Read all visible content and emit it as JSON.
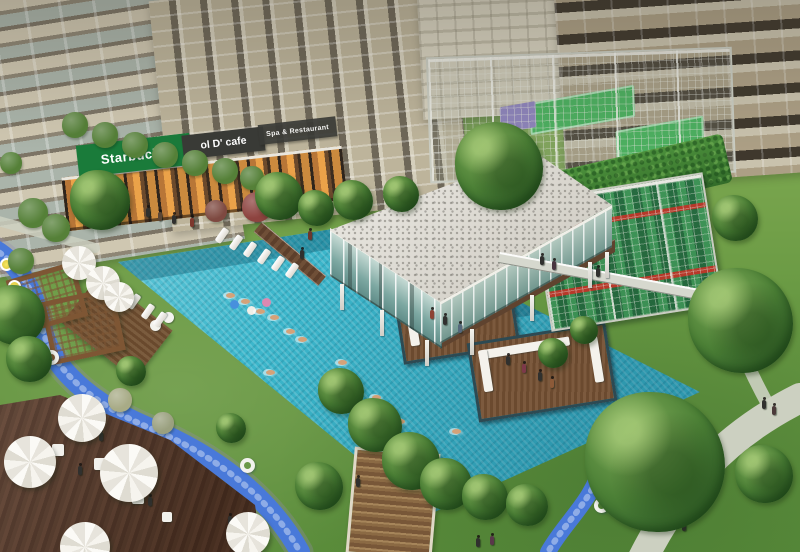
{
  "scene": {
    "description": "Aerial rendering of a condominium amenity court: lap pool with floating lounge decks, glass clubhouse with pebble roof, caged rooftop sports courts, climbing-wall pavilion, lazy-river streams, umbrella dining decks and high-rise towers",
    "signs": {
      "starbucks": "Starbucks",
      "cafe": "ol D' cafe",
      "spa": "Spa & Restaurant"
    },
    "colors": {
      "pool": "#41b6ca",
      "deep": "#1f7f9b",
      "grass": "#6f9c4a",
      "wood": "#5e4030",
      "stream": "#4b79d4",
      "roof": "#e3e0da",
      "facade": "#b5a88e",
      "glass": "#9fc3bd",
      "green": "#1d7a3c",
      "signdark": "#393a36",
      "court": "#4fae62",
      "red": "#b23a2c",
      "path": "#ccd0c2"
    },
    "sprites": [
      {
        "t": "col",
        "x": 340,
        "y": 284
      },
      {
        "t": "col",
        "x": 380,
        "y": 310
      },
      {
        "t": "col",
        "x": 425,
        "y": 340
      },
      {
        "t": "col",
        "x": 470,
        "y": 329
      },
      {
        "t": "col",
        "x": 530,
        "y": 295
      },
      {
        "t": "col",
        "x": 588,
        "y": 262
      },
      {
        "t": "col",
        "x": 605,
        "y": 252
      },
      {
        "t": "tbl",
        "x": 52,
        "y": 444,
        "s": 12
      },
      {
        "t": "tbl",
        "x": 94,
        "y": 458,
        "s": 12
      },
      {
        "t": "tbl",
        "x": 132,
        "y": 492,
        "s": 12
      },
      {
        "t": "tbl",
        "x": 162,
        "y": 512,
        "s": 10
      },
      {
        "t": "puff",
        "x": 150,
        "y": 320,
        "s": 11
      },
      {
        "t": "puff",
        "x": 163,
        "y": 312,
        "s": 11
      },
      {
        "t": "lounger",
        "x": 214,
        "y": 232
      },
      {
        "t": "lounger",
        "x": 228,
        "y": 239
      },
      {
        "t": "lounger",
        "x": 242,
        "y": 246
      },
      {
        "t": "lounger",
        "x": 256,
        "y": 253
      },
      {
        "t": "lounger",
        "x": 270,
        "y": 260
      },
      {
        "t": "lounger",
        "x": 284,
        "y": 267
      },
      {
        "t": "lounger",
        "x": 126,
        "y": 298
      },
      {
        "t": "lounger",
        "x": 140,
        "y": 308
      },
      {
        "t": "lounger",
        "x": 152,
        "y": 316
      },
      {
        "t": "ring",
        "x": 594,
        "y": 498
      },
      {
        "t": "ring",
        "x": 240,
        "y": 458
      },
      {
        "t": "ring",
        "x": 44,
        "y": 350
      },
      {
        "t": "fyel",
        "x": 0,
        "y": 258
      },
      {
        "t": "fyel",
        "x": 8,
        "y": 280
      },
      {
        "t": "fball",
        "x": 230,
        "y": 300,
        "c": "#4a90d9"
      },
      {
        "t": "fball",
        "x": 262,
        "y": 298,
        "c": "#d98ab0"
      },
      {
        "t": "fball",
        "x": 247,
        "y": 306,
        "c": "#f0efe8"
      },
      {
        "t": "swim",
        "x": 226,
        "y": 293
      },
      {
        "t": "swim",
        "x": 241,
        "y": 299
      },
      {
        "t": "swim",
        "x": 256,
        "y": 309
      },
      {
        "t": "swim",
        "x": 270,
        "y": 315
      },
      {
        "t": "swim",
        "x": 286,
        "y": 329
      },
      {
        "t": "swim",
        "x": 298,
        "y": 337
      },
      {
        "t": "swim",
        "x": 338,
        "y": 360
      },
      {
        "t": "swim",
        "x": 266,
        "y": 370
      },
      {
        "t": "swim",
        "x": 372,
        "y": 395
      },
      {
        "t": "swim",
        "x": 396,
        "y": 419
      },
      {
        "t": "swim",
        "x": 452,
        "y": 429
      },
      {
        "t": "person",
        "x": 146,
        "y": 208,
        "c": "#30302e"
      },
      {
        "t": "person",
        "x": 158,
        "y": 212,
        "c": "#5a4636"
      },
      {
        "t": "person",
        "x": 172,
        "y": 215,
        "c": "#30302e"
      },
      {
        "t": "person",
        "x": 190,
        "y": 218,
        "c": "#7a382e"
      },
      {
        "t": "person",
        "x": 122,
        "y": 204,
        "c": "#30302e"
      },
      {
        "t": "person",
        "x": 46,
        "y": 222,
        "c": "#30302e"
      },
      {
        "t": "person",
        "x": 58,
        "y": 228,
        "c": "#46465a"
      },
      {
        "t": "person",
        "x": 300,
        "y": 250,
        "c": "#30302e"
      },
      {
        "t": "person",
        "x": 308,
        "y": 231,
        "c": "#6a382e"
      },
      {
        "t": "person",
        "x": 540,
        "y": 256,
        "c": "#30302e"
      },
      {
        "t": "person",
        "x": 552,
        "y": 261,
        "c": "#483440"
      },
      {
        "t": "person",
        "x": 596,
        "y": 268,
        "c": "#30302e"
      },
      {
        "t": "person",
        "x": 430,
        "y": 310,
        "c": "#8a4436"
      },
      {
        "t": "person",
        "x": 443,
        "y": 316,
        "c": "#30302e"
      },
      {
        "t": "person",
        "x": 458,
        "y": 324,
        "c": "#56687a"
      },
      {
        "t": "person",
        "x": 506,
        "y": 356,
        "c": "#30302e"
      },
      {
        "t": "person",
        "x": 522,
        "y": 364,
        "c": "#7a3a4a"
      },
      {
        "t": "person",
        "x": 538,
        "y": 372,
        "c": "#30302e"
      },
      {
        "t": "person",
        "x": 550,
        "y": 379,
        "c": "#8a5a3a"
      },
      {
        "t": "person",
        "x": 476,
        "y": 538,
        "c": "#30302e"
      },
      {
        "t": "person",
        "x": 490,
        "y": 536,
        "c": "#58384a"
      },
      {
        "t": "person",
        "x": 690,
        "y": 494,
        "c": "#30302e"
      },
      {
        "t": "person",
        "x": 700,
        "y": 498,
        "c": "#553a38"
      },
      {
        "t": "person",
        "x": 682,
        "y": 522,
        "c": "#30302e"
      },
      {
        "t": "person",
        "x": 730,
        "y": 290,
        "c": "#30302e"
      },
      {
        "t": "person",
        "x": 740,
        "y": 294,
        "c": "#4a3a4e"
      },
      {
        "t": "person",
        "x": 750,
        "y": 289,
        "c": "#30302e"
      },
      {
        "t": "person",
        "x": 758,
        "y": 295,
        "c": "#5a4838"
      },
      {
        "t": "person",
        "x": 90,
        "y": 428,
        "c": "#7a382e"
      },
      {
        "t": "person",
        "x": 99,
        "y": 432,
        "c": "#30302e"
      },
      {
        "t": "person",
        "x": 78,
        "y": 466,
        "c": "#30302e"
      },
      {
        "t": "person",
        "x": 116,
        "y": 488,
        "c": "#46465a"
      },
      {
        "t": "person",
        "x": 148,
        "y": 497,
        "c": "#30302e"
      },
      {
        "t": "person",
        "x": 228,
        "y": 516,
        "c": "#30302e"
      },
      {
        "t": "person",
        "x": 356,
        "y": 478,
        "c": "#30302e"
      },
      {
        "t": "person",
        "x": 762,
        "y": 400,
        "c": "#30302e"
      },
      {
        "t": "person",
        "x": 772,
        "y": 406,
        "c": "#4a3a3a"
      },
      {
        "t": "bush",
        "x": 62,
        "y": 112,
        "s": 26
      },
      {
        "t": "bush",
        "x": 92,
        "y": 122,
        "s": 26
      },
      {
        "t": "bush",
        "x": 122,
        "y": 132,
        "s": 26
      },
      {
        "t": "bush",
        "x": 152,
        "y": 142,
        "s": 26
      },
      {
        "t": "bush",
        "x": 182,
        "y": 150,
        "s": 26
      },
      {
        "t": "bush",
        "x": 212,
        "y": 158,
        "s": 26
      },
      {
        "t": "bush",
        "x": 240,
        "y": 166,
        "s": 24
      },
      {
        "t": "bush",
        "x": 18,
        "y": 198,
        "s": 30
      },
      {
        "t": "bush",
        "x": 42,
        "y": 214,
        "s": 28
      },
      {
        "t": "bush",
        "x": 8,
        "y": 248,
        "s": 26
      },
      {
        "t": "bush",
        "x": 0,
        "y": 152,
        "s": 22
      },
      {
        "t": "bush",
        "x": 242,
        "y": 192,
        "s": 30,
        "c": "#8a4440"
      },
      {
        "t": "bush",
        "x": 205,
        "y": 200,
        "s": 22,
        "c": "#7c4a42"
      },
      {
        "t": "bush",
        "x": 108,
        "y": 388,
        "s": 24,
        "c": "#a8ab88"
      },
      {
        "t": "bush",
        "x": 152,
        "y": 412,
        "s": 22,
        "c": "#9aa080"
      },
      {
        "t": "tree",
        "x": 585,
        "y": 392,
        "s": 140
      },
      {
        "t": "tree",
        "x": 688,
        "y": 268,
        "s": 105
      },
      {
        "t": "tree",
        "x": 318,
        "y": 368,
        "s": 46
      },
      {
        "t": "tree",
        "x": 348,
        "y": 398,
        "s": 54
      },
      {
        "t": "tree",
        "x": 382,
        "y": 432,
        "s": 58
      },
      {
        "t": "tree",
        "x": 420,
        "y": 458,
        "s": 52
      },
      {
        "t": "tree",
        "x": 462,
        "y": 474,
        "s": 46
      },
      {
        "t": "tree",
        "x": 506,
        "y": 484,
        "s": 42
      },
      {
        "t": "tree",
        "x": 295,
        "y": 462,
        "s": 48
      },
      {
        "t": "tree",
        "x": 70,
        "y": 170,
        "s": 60
      },
      {
        "t": "tree",
        "x": 255,
        "y": 172,
        "s": 48
      },
      {
        "t": "tree",
        "x": 298,
        "y": 190,
        "s": 36
      },
      {
        "t": "tree",
        "x": 333,
        "y": 180,
        "s": 40
      },
      {
        "t": "tree",
        "x": 383,
        "y": 176,
        "s": 36
      },
      {
        "t": "tree",
        "x": 455,
        "y": 122,
        "s": 88
      },
      {
        "t": "tree",
        "x": -15,
        "y": 285,
        "s": 60
      },
      {
        "t": "tree",
        "x": 6,
        "y": 336,
        "s": 46
      },
      {
        "t": "tree",
        "x": 735,
        "y": 445,
        "s": 58
      },
      {
        "t": "tree",
        "x": 538,
        "y": 338,
        "s": 30
      },
      {
        "t": "tree",
        "x": 570,
        "y": 316,
        "s": 28
      },
      {
        "t": "tree",
        "x": 216,
        "y": 413,
        "s": 30
      },
      {
        "t": "tree",
        "x": 116,
        "y": 356,
        "s": 30
      },
      {
        "t": "tree",
        "x": 712,
        "y": 195,
        "s": 46
      },
      {
        "t": "umb",
        "x": 4,
        "y": 436,
        "s": 52
      },
      {
        "t": "umb",
        "x": 58,
        "y": 394,
        "s": 48
      },
      {
        "t": "umb",
        "x": 100,
        "y": 444,
        "s": 58
      },
      {
        "t": "umb",
        "x": 60,
        "y": 522,
        "s": 50
      },
      {
        "t": "umb",
        "x": 226,
        "y": 512,
        "s": 44
      },
      {
        "t": "umb",
        "x": 62,
        "y": 246,
        "s": 34
      },
      {
        "t": "umb",
        "x": 86,
        "y": 266,
        "s": 34
      },
      {
        "t": "umb",
        "x": 104,
        "y": 282,
        "s": 30
      }
    ]
  }
}
